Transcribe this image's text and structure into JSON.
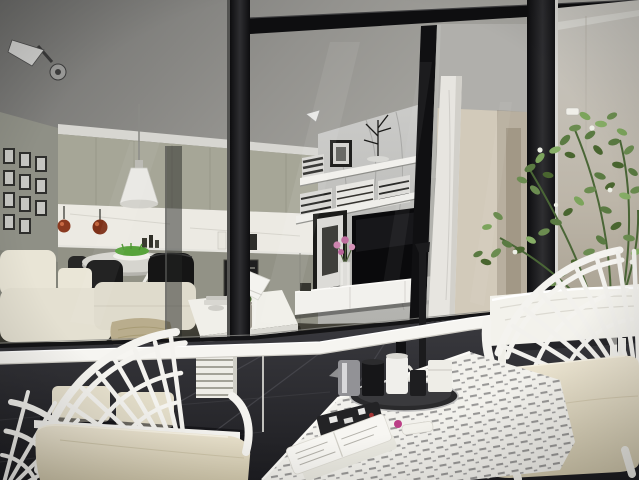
{
  "scene": {
    "type": "architectural-render-photo",
    "description": "Modern apartment interior seen from a balcony through black-framed floor-to-ceiling glass sliding doors; white peacock-fan outdoor chairs with beige cushions and a white laser-cut table sit on dark charcoal balcony tiles; inside are an olive-toned kitchen, round dining table with black chairs, white sofa, marble TV wall with floating shelves and a leafy green plant on the right.",
    "palette": {
      "ceiling_dark": "#6e6e6c",
      "ceiling_light": "#b0afa9",
      "bulkhead_white": "#d7d6d1",
      "left_wall": "#8f9086",
      "cabinet_upper": "#a6a697",
      "cabinet_lower": "#929286",
      "backsplash": "#eceae3",
      "marble_wall": "#c6c6c3",
      "hall_wall": "#d2caba",
      "right_wall": "#c2bfb6",
      "frame_black": "#121214",
      "interior_floor": "#46443c",
      "balcony_floor": "#2e2e32",
      "furniture_white": "#f4f3ef",
      "rail_white": "#f6f5f1",
      "cushion_beige": "#e3dcc6",
      "sofa_cream": "#e6e2d3",
      "plant_green": "#5a7a42",
      "tv_black": "#0a0a0c",
      "copper_pot": "#8a3a20",
      "grass_green": "#57a33a",
      "flower_pink": "#cd84ae",
      "throw_tan": "#b9ad8d"
    },
    "objects": [
      {
        "name": "ceiling-spotlight",
        "desc": "twin track spotlights on balcony ceiling, top left"
      },
      {
        "name": "gallery-wall",
        "desc": "grid of small black-and-white framed photos on left wall"
      },
      {
        "name": "kitchen-cabinets",
        "desc": "olive-grey upper and lower cabinet runs with lit white backsplash"
      },
      {
        "name": "copper-pots",
        "desc": "two copper pots hanging in front of backsplash"
      },
      {
        "name": "pendant-lamp",
        "desc": "white cone pendant over dining table"
      },
      {
        "name": "dining-table",
        "desc": "round white table with trestle legs and green grass centerpiece"
      },
      {
        "name": "dining-chairs",
        "desc": "black shell chairs around dining table"
      },
      {
        "name": "sofa",
        "desc": "cream modular sofa with tan throw"
      },
      {
        "name": "coffee-table",
        "desc": "low white table with potted succulent and white angled lamp"
      },
      {
        "name": "book-stack",
        "desc": "stack of white books beside sofa"
      },
      {
        "name": "marble-wall",
        "desc": "grey marble feature wall"
      },
      {
        "name": "floating-shelves",
        "desc": "two white shelves with stacked books, frame and twig tree"
      },
      {
        "name": "tv",
        "desc": "flat screen TV on white media console"
      },
      {
        "name": "leaning-art",
        "desc": "black framed artwork leaning at TV wall"
      },
      {
        "name": "flower-vase",
        "desc": "pink flowers in small vase"
      },
      {
        "name": "media-console",
        "desc": "long white low media cabinet"
      },
      {
        "name": "glass-doors",
        "desc": "black-framed sliding glass doors and corner post"
      },
      {
        "name": "marble-column",
        "desc": "light marble pillar at door edge"
      },
      {
        "name": "hallway",
        "desc": "beige hallway beyond living room"
      },
      {
        "name": "right-wall",
        "desc": "beige balcony side wall with small handle"
      },
      {
        "name": "plant",
        "desc": "tall leafy green plant with tiny white flowers, right side"
      },
      {
        "name": "railing",
        "desc": "white balcony handrail sloping toward the right"
      },
      {
        "name": "black-floor-lamp",
        "desc": "black pole lamp with round base on balcony"
      },
      {
        "name": "balcony-bench",
        "desc": "white bench with rumpled cover behind right chair"
      },
      {
        "name": "chair-left",
        "desc": "white peacock-fan chair with beige cushions, bottom left"
      },
      {
        "name": "chair-right",
        "desc": "white peacock-fan chair with beige cushion, bottom right"
      },
      {
        "name": "outdoor-table",
        "desc": "white laser-cut perforated table"
      },
      {
        "name": "tray-set",
        "desc": "round dark tray with black and white cups and chrome jug"
      },
      {
        "name": "magazines",
        "desc": "white magazines, black patterned clutch and cosmetics on table"
      },
      {
        "name": "balcony-floor",
        "desc": "dark charcoal tile floor"
      }
    ]
  }
}
